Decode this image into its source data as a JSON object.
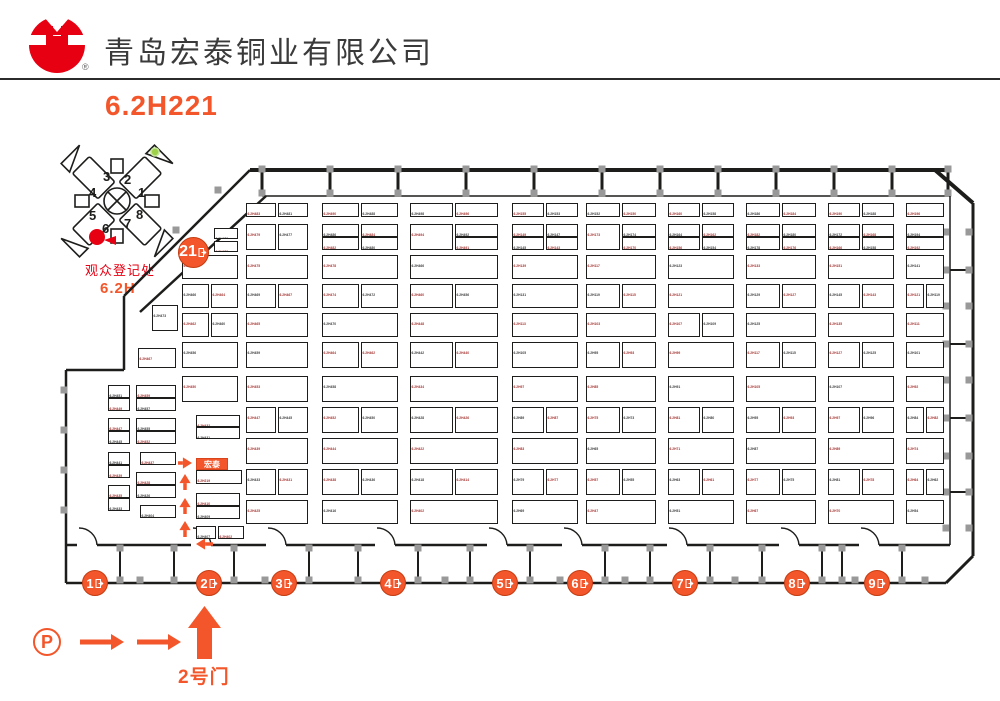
{
  "header": {
    "title": "青岛宏泰铜业有限公司",
    "reg_mark": "®",
    "booth_code": "6.2H221"
  },
  "colors": {
    "accent": "#f3562a",
    "red": "#e60012",
    "label_red": "#a33431",
    "label_dark": "#3b3b3b",
    "wall": "#1d1d1b",
    "pillar": "#999999"
  },
  "mini_map": {
    "wing_numbers": [
      "1",
      "2",
      "3",
      "4",
      "5",
      "6",
      "7",
      "8"
    ],
    "registration_label": "观众登记处",
    "hall_label": "6.2H"
  },
  "footer": {
    "parking_label": "P",
    "gate_label": "2号门"
  },
  "plan": {
    "hall_gate": {
      "label": "21",
      "x": 193,
      "y": 252
    },
    "gates": [
      {
        "label": "1",
        "x": 95
      },
      {
        "label": "2",
        "x": 209
      },
      {
        "label": "3",
        "x": 284
      },
      {
        "label": "4",
        "x": 393
      },
      {
        "label": "5",
        "x": 505
      },
      {
        "label": "6",
        "x": 580
      },
      {
        "label": "7",
        "x": 685
      },
      {
        "label": "8",
        "x": 797
      },
      {
        "label": "9",
        "x": 877
      }
    ],
    "gates_y": 583,
    "highlight_booth": {
      "label": "宏泰",
      "x": 196,
      "y": 458,
      "w": 32,
      "h": 12
    },
    "booths_key": "x,y,w,h,label,is_red",
    "booths": [
      [
        108,
        385,
        22,
        13,
        "6.2H451",
        0
      ],
      [
        108,
        398,
        22,
        13,
        "6.2H449",
        1
      ],
      [
        108,
        418,
        22,
        13,
        "6.2H447",
        1
      ],
      [
        108,
        431,
        22,
        13,
        "6.2H445",
        0
      ],
      [
        108,
        452,
        22,
        13,
        "6.2H441",
        0
      ],
      [
        108,
        465,
        22,
        13,
        "6.2H439",
        1
      ],
      [
        108,
        485,
        22,
        13,
        "6.2H435",
        1
      ],
      [
        108,
        498,
        22,
        13,
        "6.2H433",
        0
      ],
      [
        152,
        305,
        26,
        26,
        "6.2H473",
        0
      ],
      [
        138,
        348,
        38,
        20,
        "6.2H467",
        1
      ],
      [
        136,
        385,
        40,
        13,
        "6.2H459",
        1
      ],
      [
        136,
        398,
        40,
        13,
        "6.2H457",
        0
      ],
      [
        136,
        418,
        40,
        13,
        "6.2H455",
        0
      ],
      [
        136,
        431,
        40,
        13,
        "6.2H452",
        1
      ],
      [
        140,
        452,
        36,
        13,
        "6.2H437",
        1
      ],
      [
        136,
        472,
        40,
        13,
        "6.2H428",
        1
      ],
      [
        136,
        485,
        40,
        13,
        "6.2H426",
        0
      ],
      [
        140,
        505,
        36,
        13,
        "6.2H404",
        0
      ],
      [
        214,
        228,
        24,
        11,
        "6.2H476",
        0
      ],
      [
        214,
        241,
        24,
        11,
        "6.2H472",
        1
      ],
      [
        182,
        255,
        56,
        24,
        "6.2H474",
        1
      ],
      [
        182,
        284,
        27,
        24,
        "6.2H466",
        0
      ],
      [
        211,
        284,
        27,
        24,
        "6.2H464",
        1
      ],
      [
        182,
        313,
        27,
        24,
        "6.2H462",
        1
      ],
      [
        211,
        313,
        27,
        24,
        "6.2H460",
        0
      ],
      [
        182,
        342,
        56,
        26,
        "6.2H456",
        0
      ],
      [
        182,
        376,
        56,
        26,
        "6.2H450",
        1
      ],
      [
        196,
        415,
        44,
        12,
        "6.2H432",
        1
      ],
      [
        196,
        427,
        44,
        12,
        "6.2H431",
        0
      ],
      [
        196,
        470,
        46,
        14,
        "6.2H219",
        1
      ],
      [
        196,
        493,
        44,
        13,
        "6.2H410",
        1
      ],
      [
        196,
        506,
        44,
        13,
        "6.2H409",
        0
      ],
      [
        196,
        526,
        20,
        13,
        "6.2H407",
        0
      ],
      [
        218,
        526,
        26,
        13,
        "6.2H402",
        1
      ],
      [
        246,
        203,
        30,
        14,
        "6.2H483",
        1
      ],
      [
        278,
        203,
        30,
        14,
        "6.2H481",
        0
      ],
      [
        246,
        224,
        30,
        26,
        "6.2H479",
        1
      ],
      [
        278,
        224,
        30,
        26,
        "6.2H477",
        0
      ],
      [
        246,
        255,
        62,
        24,
        "6.2H475",
        1
      ],
      [
        246,
        284,
        30,
        24,
        "6.2H469",
        0
      ],
      [
        278,
        284,
        30,
        24,
        "6.2H467",
        1
      ],
      [
        246,
        313,
        62,
        24,
        "6.2H465",
        1
      ],
      [
        246,
        342,
        62,
        26,
        "6.2H459",
        0
      ],
      [
        246,
        376,
        62,
        26,
        "6.2H453",
        1
      ],
      [
        246,
        407,
        30,
        26,
        "6.2H447",
        1
      ],
      [
        278,
        407,
        30,
        26,
        "6.2H445",
        0
      ],
      [
        246,
        438,
        62,
        26,
        "6.2H439",
        1
      ],
      [
        246,
        469,
        30,
        26,
        "6.2H433",
        0
      ],
      [
        278,
        469,
        30,
        26,
        "6.2H431",
        1
      ],
      [
        246,
        500,
        62,
        24,
        "6.2H425",
        1
      ],
      [
        322,
        203,
        37,
        14,
        "6.2H490",
        1
      ],
      [
        361,
        203,
        37,
        14,
        "6.2H488",
        0
      ],
      [
        322,
        224,
        37,
        13,
        "6.2H486",
        0
      ],
      [
        361,
        224,
        37,
        13,
        "6.2H484",
        1
      ],
      [
        322,
        237,
        37,
        13,
        "6.2H482",
        1
      ],
      [
        361,
        237,
        37,
        13,
        "6.2H480",
        0
      ],
      [
        322,
        255,
        76,
        24,
        "6.2H478",
        1
      ],
      [
        322,
        284,
        37,
        24,
        "6.2H474",
        1
      ],
      [
        361,
        284,
        37,
        24,
        "6.2H472",
        0
      ],
      [
        322,
        313,
        76,
        24,
        "6.2H470",
        0
      ],
      [
        322,
        342,
        37,
        26,
        "6.2H464",
        1
      ],
      [
        361,
        342,
        37,
        26,
        "6.2H462",
        1
      ],
      [
        322,
        376,
        76,
        26,
        "6.2H458",
        0
      ],
      [
        322,
        407,
        37,
        26,
        "6.2H452",
        1
      ],
      [
        361,
        407,
        37,
        26,
        "6.2H450",
        0
      ],
      [
        322,
        438,
        76,
        26,
        "6.2H444",
        1
      ],
      [
        322,
        469,
        37,
        26,
        "6.2H438",
        1
      ],
      [
        361,
        469,
        37,
        26,
        "6.2H436",
        0
      ],
      [
        322,
        500,
        76,
        24,
        "6.2H416",
        0
      ],
      [
        410,
        203,
        43,
        14,
        "6.2H498",
        0
      ],
      [
        455,
        203,
        43,
        14,
        "6.2H496",
        1
      ],
      [
        410,
        224,
        43,
        26,
        "6.2H494",
        1
      ],
      [
        455,
        224,
        43,
        13,
        "6.2H492",
        0
      ],
      [
        455,
        237,
        43,
        13,
        "6.2H491",
        1
      ],
      [
        410,
        255,
        88,
        24,
        "6.2H466",
        0
      ],
      [
        410,
        284,
        43,
        24,
        "6.2H460",
        1
      ],
      [
        455,
        284,
        43,
        24,
        "6.2H456",
        0
      ],
      [
        410,
        313,
        88,
        24,
        "6.2H448",
        1
      ],
      [
        410,
        342,
        43,
        26,
        "6.2H442",
        0
      ],
      [
        455,
        342,
        43,
        26,
        "6.2H440",
        1
      ],
      [
        410,
        376,
        88,
        26,
        "6.2H434",
        1
      ],
      [
        410,
        407,
        43,
        26,
        "6.2H428",
        0
      ],
      [
        455,
        407,
        43,
        26,
        "6.2H426",
        1
      ],
      [
        410,
        438,
        88,
        26,
        "6.2H422",
        1
      ],
      [
        410,
        469,
        43,
        26,
        "6.2H418",
        0
      ],
      [
        455,
        469,
        43,
        26,
        "6.2H414",
        1
      ],
      [
        410,
        500,
        88,
        24,
        "6.2H402",
        1
      ],
      [
        512,
        203,
        32,
        14,
        "6.2H155",
        1
      ],
      [
        546,
        203,
        32,
        14,
        "6.2H153",
        0
      ],
      [
        512,
        224,
        32,
        13,
        "6.2H149",
        1
      ],
      [
        546,
        224,
        32,
        13,
        "6.2H147",
        0
      ],
      [
        512,
        237,
        32,
        13,
        "6.2H145",
        0
      ],
      [
        546,
        237,
        32,
        13,
        "6.2H143",
        1
      ],
      [
        512,
        255,
        66,
        24,
        "6.2H139",
        1
      ],
      [
        512,
        284,
        66,
        24,
        "6.2H131",
        0
      ],
      [
        512,
        313,
        66,
        24,
        "6.2H113",
        1
      ],
      [
        512,
        342,
        66,
        26,
        "6.2H105",
        0
      ],
      [
        512,
        376,
        66,
        26,
        "6.2H97",
        1
      ],
      [
        512,
        407,
        32,
        26,
        "6.2H89",
        0
      ],
      [
        546,
        407,
        32,
        26,
        "6.2H87",
        1
      ],
      [
        512,
        438,
        66,
        26,
        "6.2H83",
        1
      ],
      [
        512,
        469,
        32,
        26,
        "6.2H79",
        0
      ],
      [
        546,
        469,
        32,
        26,
        "6.2H77",
        1
      ],
      [
        512,
        500,
        66,
        24,
        "6.2H69",
        0
      ],
      [
        586,
        203,
        34,
        14,
        "6.2H152",
        0
      ],
      [
        622,
        203,
        34,
        14,
        "6.2H150",
        1
      ],
      [
        586,
        224,
        34,
        26,
        "6.2H173",
        1
      ],
      [
        622,
        224,
        34,
        13,
        "6.2H174",
        0
      ],
      [
        622,
        237,
        34,
        13,
        "6.2H170",
        1
      ],
      [
        586,
        255,
        70,
        24,
        "6.2H117",
        1
      ],
      [
        586,
        284,
        34,
        24,
        "6.2H119",
        0
      ],
      [
        622,
        284,
        34,
        24,
        "6.2H115",
        1
      ],
      [
        586,
        313,
        70,
        24,
        "6.2H103",
        1
      ],
      [
        586,
        342,
        34,
        26,
        "6.2H95",
        0
      ],
      [
        622,
        342,
        34,
        26,
        "6.2H93",
        1
      ],
      [
        586,
        376,
        70,
        26,
        "6.2H85",
        1
      ],
      [
        586,
        407,
        34,
        26,
        "6.2H75",
        1
      ],
      [
        622,
        407,
        34,
        26,
        "6.2H73",
        0
      ],
      [
        586,
        438,
        70,
        26,
        "6.2H65",
        0
      ],
      [
        586,
        469,
        34,
        26,
        "6.2H57",
        1
      ],
      [
        622,
        469,
        34,
        26,
        "6.2H55",
        0
      ],
      [
        586,
        500,
        70,
        24,
        "6.2H47",
        1
      ],
      [
        668,
        203,
        32,
        14,
        "6.2H160",
        1
      ],
      [
        702,
        203,
        32,
        14,
        "6.2H158",
        0
      ],
      [
        668,
        224,
        32,
        13,
        "6.2H164",
        0
      ],
      [
        702,
        224,
        32,
        13,
        "6.2H162",
        1
      ],
      [
        668,
        237,
        32,
        13,
        "6.2H156",
        1
      ],
      [
        702,
        237,
        32,
        13,
        "6.2H154",
        0
      ],
      [
        668,
        255,
        66,
        24,
        "6.2H123",
        0
      ],
      [
        668,
        284,
        66,
        24,
        "6.2H121",
        1
      ],
      [
        668,
        313,
        32,
        24,
        "6.2H107",
        1
      ],
      [
        702,
        313,
        32,
        24,
        "6.2H109",
        0
      ],
      [
        668,
        342,
        66,
        26,
        "6.2H99",
        1
      ],
      [
        668,
        376,
        66,
        26,
        "6.2H91",
        0
      ],
      [
        668,
        407,
        32,
        26,
        "6.2H81",
        1
      ],
      [
        702,
        407,
        32,
        26,
        "6.2H80",
        0
      ],
      [
        668,
        438,
        66,
        26,
        "6.2H71",
        1
      ],
      [
        668,
        469,
        32,
        26,
        "6.2H63",
        0
      ],
      [
        702,
        469,
        32,
        26,
        "6.2H61",
        1
      ],
      [
        668,
        500,
        66,
        24,
        "6.2H51",
        0
      ],
      [
        746,
        203,
        34,
        14,
        "6.2H186",
        0
      ],
      [
        782,
        203,
        34,
        14,
        "6.2H184",
        1
      ],
      [
        746,
        224,
        34,
        13,
        "6.2H182",
        1
      ],
      [
        782,
        224,
        34,
        13,
        "6.2H180",
        0
      ],
      [
        746,
        237,
        34,
        13,
        "6.2H178",
        0
      ],
      [
        782,
        237,
        34,
        13,
        "6.2H176",
        1
      ],
      [
        746,
        255,
        70,
        24,
        "6.2H133",
        1
      ],
      [
        746,
        284,
        34,
        24,
        "6.2H129",
        0
      ],
      [
        782,
        284,
        34,
        24,
        "6.2H127",
        1
      ],
      [
        746,
        313,
        70,
        24,
        "6.2H125",
        0
      ],
      [
        746,
        342,
        34,
        26,
        "6.2H117",
        1
      ],
      [
        782,
        342,
        34,
        26,
        "6.2H115",
        0
      ],
      [
        746,
        376,
        70,
        26,
        "6.2H105",
        1
      ],
      [
        746,
        407,
        34,
        26,
        "6.2H95",
        0
      ],
      [
        782,
        407,
        34,
        26,
        "6.2H93",
        1
      ],
      [
        746,
        438,
        70,
        26,
        "6.2H87",
        0
      ],
      [
        746,
        469,
        34,
        26,
        "6.2H77",
        1
      ],
      [
        782,
        469,
        34,
        26,
        "6.2H75",
        0
      ],
      [
        746,
        500,
        70,
        24,
        "6.2H67",
        1
      ],
      [
        828,
        203,
        32,
        14,
        "6.2H190",
        1
      ],
      [
        862,
        203,
        32,
        14,
        "6.2H188",
        0
      ],
      [
        828,
        224,
        32,
        13,
        "6.2H172",
        0
      ],
      [
        862,
        224,
        32,
        13,
        "6.2H168",
        1
      ],
      [
        828,
        237,
        32,
        13,
        "6.2H166",
        1
      ],
      [
        862,
        237,
        32,
        13,
        "6.2H158",
        0
      ],
      [
        828,
        255,
        66,
        24,
        "6.2H151",
        1
      ],
      [
        828,
        284,
        32,
        24,
        "6.2H145",
        0
      ],
      [
        862,
        284,
        32,
        24,
        "6.2H143",
        1
      ],
      [
        828,
        313,
        66,
        24,
        "6.2H135",
        1
      ],
      [
        828,
        342,
        32,
        26,
        "6.2H127",
        1
      ],
      [
        862,
        342,
        32,
        26,
        "6.2H125",
        0
      ],
      [
        828,
        376,
        66,
        26,
        "6.2H107",
        0
      ],
      [
        828,
        407,
        32,
        26,
        "6.2H97",
        1
      ],
      [
        862,
        407,
        32,
        26,
        "6.2H96",
        0
      ],
      [
        828,
        438,
        66,
        26,
        "6.2H89",
        1
      ],
      [
        828,
        469,
        32,
        26,
        "6.2H81",
        0
      ],
      [
        862,
        469,
        32,
        26,
        "6.2H78",
        1
      ],
      [
        828,
        500,
        66,
        24,
        "6.2H70",
        1
      ],
      [
        906,
        203,
        38,
        14,
        "6.2H196",
        1
      ],
      [
        906,
        224,
        38,
        13,
        "6.2H194",
        0
      ],
      [
        906,
        237,
        38,
        13,
        "6.2H192",
        1
      ],
      [
        906,
        255,
        38,
        24,
        "6.2H141",
        0
      ],
      [
        906,
        284,
        18,
        24,
        "6.2H121",
        1
      ],
      [
        926,
        284,
        18,
        24,
        "6.2H119",
        0
      ],
      [
        906,
        313,
        38,
        24,
        "6.2H111",
        1
      ],
      [
        906,
        342,
        38,
        26,
        "6.2H101",
        0
      ],
      [
        906,
        376,
        38,
        26,
        "6.2H92",
        1
      ],
      [
        906,
        407,
        18,
        26,
        "6.2H84",
        0
      ],
      [
        926,
        407,
        18,
        26,
        "6.2H82",
        1
      ],
      [
        906,
        438,
        38,
        26,
        "6.2H74",
        1
      ],
      [
        906,
        469,
        18,
        26,
        "6.2H64",
        1
      ],
      [
        926,
        469,
        18,
        26,
        "6.2H62",
        0
      ],
      [
        906,
        500,
        38,
        24,
        "6.2H54",
        0
      ]
    ]
  }
}
